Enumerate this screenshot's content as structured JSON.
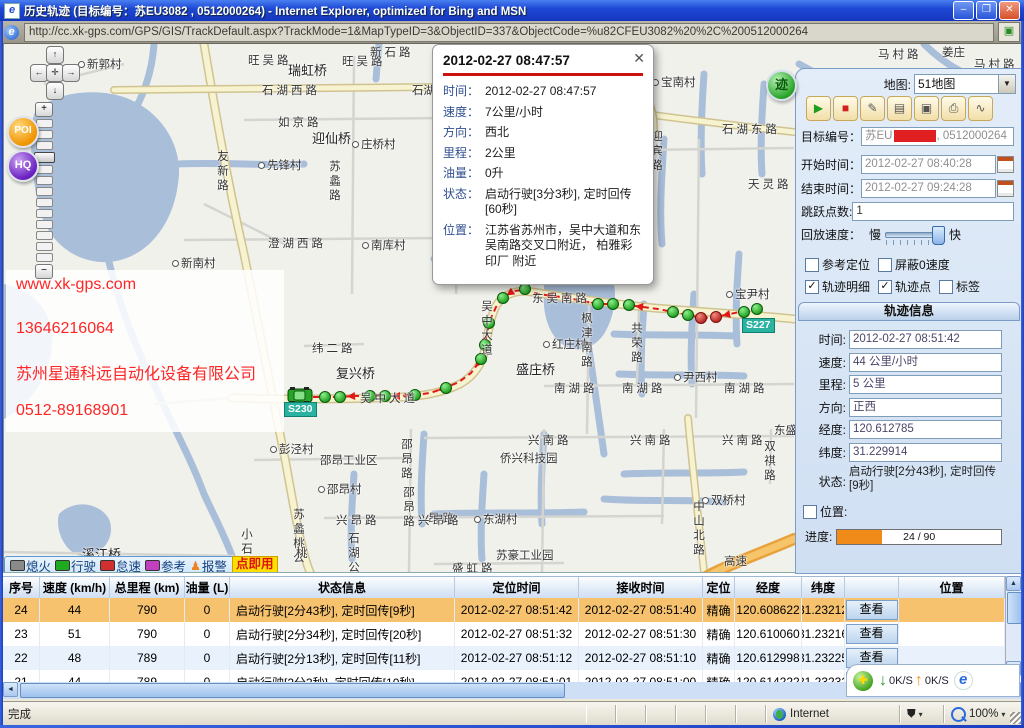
{
  "window": {
    "title": "历史轨迹 (目标编号：苏EU3082 , 0512000264) - Internet Explorer, optimized for Bing and MSN",
    "icon_glyph": "e",
    "controls": {
      "minimize": "–",
      "maximize": "❐",
      "close": "✕"
    }
  },
  "address_bar": {
    "url": "http://cc.xk-gps.com/GPS/GIS/TrackDefault.aspx?TrackMode=1&MapTypeID=3&ObjectID=337&ObjectCode=%u82CFEU3082%20%2C%200512000264",
    "page_icon": "▣"
  },
  "map": {
    "popup": {
      "title": "2012-02-27 08:47:57",
      "close": "✕",
      "fields": [
        {
          "label": "时间：",
          "value": "2012-02-27 08:47:57"
        },
        {
          "label": "速度：",
          "value": "7公里/小时"
        },
        {
          "label": "方向：",
          "value": "西北"
        },
        {
          "label": "里程：",
          "value": "2公里"
        },
        {
          "label": "油量：",
          "value": "0升"
        },
        {
          "label": "状态：",
          "value": "启动行驶[3分3秒], 定时回传[60秒]"
        },
        {
          "label": "位置：",
          "value": "江苏省苏州市，吴中大道和东吴南路交叉口附近， 柏雅彩印厂 附近"
        }
      ]
    },
    "watermark": [
      "www.xk-gps.com",
      "13646216064",
      "苏州星通科远自动化设备有限公司",
      "0512-89168901"
    ],
    "watermark_color": "#ff2626",
    "badges": [
      {
        "text": "S227",
        "x": 738,
        "y": 274
      },
      {
        "text": "S230",
        "x": 280,
        "y": 358
      }
    ],
    "poi_label": "POI",
    "hq_label": "HQ",
    "expand_label": "迹",
    "legend": {
      "items": [
        {
          "label": "熄火",
          "color": "#8a8a8a"
        },
        {
          "label": "行驶",
          "color": "#1faa1f"
        },
        {
          "label": "怠速",
          "color": "#d03030"
        },
        {
          "label": "参考",
          "color": "#c040c0"
        },
        {
          "label": "报警",
          "color": "#f08020",
          "person": true
        }
      ],
      "hint": "点即用"
    },
    "labels": [
      {
        "t": "新郭村",
        "x": 74,
        "y": 12,
        "dot": true
      },
      {
        "t": "旺吴路",
        "x": 244,
        "y": 8
      },
      {
        "t": "瑞虹桥",
        "x": 284,
        "y": 16,
        "b": true
      },
      {
        "t": "旺吴路",
        "x": 338,
        "y": 9
      },
      {
        "t": "新石路",
        "x": 366,
        "y": 0
      },
      {
        "t": "新石路",
        "x": 534,
        "y": 0
      },
      {
        "t": "石湖西路",
        "x": 258,
        "y": 38
      },
      {
        "t": "石湖",
        "x": 408,
        "y": 38
      },
      {
        "t": "如京路",
        "x": 274,
        "y": 70
      },
      {
        "t": "迎仙桥",
        "x": 308,
        "y": 84,
        "b": true
      },
      {
        "t": "庄桥村",
        "x": 348,
        "y": 92,
        "dot": true
      },
      {
        "t": "先锋村",
        "x": 254,
        "y": 113,
        "dot": true
      },
      {
        "t": "友新路",
        "x": 210,
        "y": 106,
        "v": true
      },
      {
        "t": "苏蠡路",
        "x": 322,
        "y": 116,
        "v": true
      },
      {
        "t": "澄湖西路",
        "x": 264,
        "y": 191
      },
      {
        "t": "南库村",
        "x": 358,
        "y": 193,
        "dot": true
      },
      {
        "t": "新南村",
        "x": 168,
        "y": 211,
        "dot": true
      },
      {
        "t": "宝南村",
        "x": 648,
        "y": 30,
        "dot": true
      },
      {
        "t": "石湖东路",
        "x": 718,
        "y": 77
      },
      {
        "t": "迎宾路",
        "x": 644,
        "y": 86,
        "v": true
      },
      {
        "t": "天灵路",
        "x": 744,
        "y": 132
      },
      {
        "t": "工业区",
        "x": 608,
        "y": 163
      },
      {
        "t": "吴中大道",
        "x": 474,
        "y": 256,
        "v": true
      },
      {
        "t": "东吴南路",
        "x": 528,
        "y": 246
      },
      {
        "t": "纬二路",
        "x": 308,
        "y": 296
      },
      {
        "t": "复兴桥",
        "x": 332,
        "y": 319,
        "b": true
      },
      {
        "t": "红庄村",
        "x": 539,
        "y": 292,
        "dot": true
      },
      {
        "t": "枫津南路",
        "x": 574,
        "y": 268,
        "v": true
      },
      {
        "t": "共荣路",
        "x": 624,
        "y": 278,
        "v": true
      },
      {
        "t": "盛庄桥",
        "x": 512,
        "y": 315,
        "b": true
      },
      {
        "t": "尹西村",
        "x": 670,
        "y": 325,
        "dot": true
      },
      {
        "t": "宝尹村",
        "x": 722,
        "y": 242,
        "dot": true
      },
      {
        "t": "南湖路",
        "x": 550,
        "y": 336
      },
      {
        "t": "南湖路",
        "x": 618,
        "y": 336
      },
      {
        "t": "南湖路",
        "x": 720,
        "y": 336
      },
      {
        "t": "吴中大道",
        "x": 356,
        "y": 346
      },
      {
        "t": "兴南路",
        "x": 524,
        "y": 388
      },
      {
        "t": "兴南路",
        "x": 626,
        "y": 388
      },
      {
        "t": "兴南路",
        "x": 718,
        "y": 388
      },
      {
        "t": "东盛",
        "x": 770,
        "y": 378
      },
      {
        "t": "双祺路",
        "x": 757,
        "y": 396,
        "v": true
      },
      {
        "t": "侨兴科技园",
        "x": 496,
        "y": 406
      },
      {
        "t": "双桥村",
        "x": 698,
        "y": 448,
        "dot": true
      },
      {
        "t": "中山北路",
        "x": 686,
        "y": 456,
        "v": true
      },
      {
        "t": "昂路",
        "x": 424,
        "y": 466
      },
      {
        "t": "东湖村",
        "x": 470,
        "y": 467,
        "dot": true
      },
      {
        "t": "彭泾村",
        "x": 266,
        "y": 397,
        "dot": true
      },
      {
        "t": "邵昂工业区",
        "x": 316,
        "y": 408
      },
      {
        "t": "邵昂村",
        "x": 314,
        "y": 437,
        "dot": true
      },
      {
        "t": "邵昂路",
        "x": 394,
        "y": 394,
        "v": true
      },
      {
        "t": "邵昂路",
        "x": 396,
        "y": 442,
        "v": true
      },
      {
        "t": "兴昂路",
        "x": 332,
        "y": 468
      },
      {
        "t": "兴昂路",
        "x": 414,
        "y": 468
      },
      {
        "t": "苏豪工业园",
        "x": 492,
        "y": 503
      },
      {
        "t": "盛虹路",
        "x": 448,
        "y": 516
      },
      {
        "t": "小石湖",
        "x": 234,
        "y": 484,
        "v": true
      },
      {
        "t": "苏蠡桃公",
        "x": 286,
        "y": 464,
        "v": true
      },
      {
        "t": "溪江桥",
        "x": 78,
        "y": 500,
        "b": true
      },
      {
        "t": "石湖公",
        "x": 341,
        "y": 488,
        "v": true
      },
      {
        "t": "桃",
        "x": 292,
        "y": 501
      },
      {
        "t": "高速",
        "x": 720,
        "y": 509
      },
      {
        "t": "马村路",
        "x": 874,
        "y": 2
      },
      {
        "t": "姜庄",
        "x": 938,
        "y": 0
      },
      {
        "t": "马村路",
        "x": 970,
        "y": 12
      }
    ],
    "track": {
      "path": [
        [
          753,
          265
        ],
        [
          740,
          267
        ],
        [
          726,
          270
        ],
        [
          712,
          273
        ],
        [
          698,
          274
        ],
        [
          684,
          271
        ],
        [
          669,
          268
        ],
        [
          654,
          265
        ],
        [
          639,
          263
        ],
        [
          624,
          261
        ],
        [
          609,
          260
        ],
        [
          594,
          260
        ],
        [
          579,
          257
        ],
        [
          564,
          254
        ],
        [
          549,
          252
        ],
        [
          534,
          250
        ],
        [
          521,
          246
        ],
        [
          509,
          247
        ],
        [
          500,
          253
        ],
        [
          492,
          263
        ],
        [
          486,
          276
        ],
        [
          483,
          290
        ],
        [
          480,
          304
        ],
        [
          476,
          317
        ],
        [
          467,
          329
        ],
        [
          455,
          338
        ],
        [
          441,
          344
        ],
        [
          426,
          349
        ],
        [
          411,
          351
        ],
        [
          396,
          352
        ],
        [
          381,
          352
        ],
        [
          366,
          352
        ],
        [
          351,
          352
        ],
        [
          336,
          353
        ],
        [
          321,
          353
        ],
        [
          307,
          353
        ]
      ],
      "points": [
        {
          "x": 753,
          "y": 265,
          "c": "g"
        },
        {
          "x": 740,
          "y": 268,
          "c": "g"
        },
        {
          "x": 712,
          "y": 273,
          "c": "r"
        },
        {
          "x": 697,
          "y": 274,
          "c": "r"
        },
        {
          "x": 684,
          "y": 271,
          "c": "g"
        },
        {
          "x": 669,
          "y": 268,
          "c": "g"
        },
        {
          "x": 625,
          "y": 261,
          "c": "g"
        },
        {
          "x": 609,
          "y": 260,
          "c": "g"
        },
        {
          "x": 594,
          "y": 260,
          "c": "g"
        },
        {
          "x": 521,
          "y": 245,
          "c": "g"
        },
        {
          "x": 499,
          "y": 254,
          "c": "g"
        },
        {
          "x": 485,
          "y": 279,
          "c": "g"
        },
        {
          "x": 481,
          "y": 301,
          "c": "g"
        },
        {
          "x": 477,
          "y": 315,
          "c": "g"
        },
        {
          "x": 442,
          "y": 344,
          "c": "g"
        },
        {
          "x": 411,
          "y": 351,
          "c": "g"
        },
        {
          "x": 381,
          "y": 352,
          "c": "g"
        },
        {
          "x": 366,
          "y": 352,
          "c": "g"
        },
        {
          "x": 336,
          "y": 353,
          "c": "g"
        },
        {
          "x": 321,
          "y": 353,
          "c": "g"
        }
      ],
      "car": {
        "x": 296,
        "y": 352
      }
    }
  },
  "sidebar": {
    "map_select_label": "地图:",
    "map_select_value": "51地图",
    "dd_arrow": "▼",
    "toolbar": [
      {
        "name": "play",
        "glyph": "▶",
        "color": "#1e9e1e"
      },
      {
        "name": "stop",
        "glyph": "■",
        "color": "#d02020"
      },
      {
        "name": "erase",
        "glyph": "✎",
        "color": "#555555"
      },
      {
        "name": "ruler",
        "glyph": "▤",
        "color": "#555555"
      },
      {
        "name": "measure-area",
        "glyph": "▣",
        "color": "#555555"
      },
      {
        "name": "print",
        "glyph": "⎙",
        "color": "#555555"
      },
      {
        "name": "speed-curve",
        "glyph": "∿",
        "color": "#555555"
      }
    ],
    "target_label": "目标编号：",
    "target_prefix": "苏EU",
    "target_suffix": ", 0512000264",
    "start_label": "开始时间：",
    "start_value": "2012-02-27 08:40:28",
    "end_label": "结束时间：",
    "end_value": "2012-02-27 09:24:28",
    "skip_label": "跳跃点数:",
    "skip_value": "1",
    "speed_label": "回放速度：",
    "slow": "慢",
    "fast": "快",
    "checks": [
      {
        "label": "参考定位",
        "checked": false
      },
      {
        "label": "屏蔽0速度",
        "checked": false
      },
      {
        "label": "轨迹明细",
        "checked": true
      },
      {
        "label": "轨迹点",
        "checked": true
      },
      {
        "label": "标签",
        "checked": false
      }
    ]
  },
  "track_info": {
    "header": "轨迹信息",
    "rows": [
      {
        "label": "时间:",
        "value": "2012-02-27 08:51:42"
      },
      {
        "label": "速度:",
        "value": "44 公里/小时"
      },
      {
        "label": "里程:",
        "value": "5 公里"
      },
      {
        "label": "方向:",
        "value": "正西"
      },
      {
        "label": "经度:",
        "value": "120.612785"
      },
      {
        "label": "纬度:",
        "value": "31.229914"
      }
    ],
    "status_label": "状态:",
    "status_value": "启动行驶[2分43秒], 定时回传[9秒]",
    "location_label": "位置:",
    "progress_label": "进度:",
    "progress_text": "24 / 90",
    "progress_pct": 27
  },
  "table": {
    "headers": [
      "序号",
      "速度 (km/h)",
      "总里程 (km)",
      "油量 (L)",
      "状态信息",
      "定位时间",
      "接收时间",
      "定位",
      "经度",
      "纬度",
      "",
      "位置"
    ],
    "view_label": "查看",
    "rows": [
      {
        "seq": "24",
        "speed": "44",
        "total": "790",
        "fuel": "0",
        "status": "启动行驶[2分43秒], 定时回传[9秒]",
        "fix_time": "2012-02-27 08:51:42",
        "recv_time": "2012-02-27 08:51:40",
        "fix": "精确",
        "lng": "120.608622",
        "lat": "31.23212",
        "position": "",
        "selected": true
      },
      {
        "seq": "23",
        "speed": "51",
        "total": "790",
        "fuel": "0",
        "status": "启动行驶[2分34秒], 定时回传[20秒]",
        "fix_time": "2012-02-27 08:51:32",
        "recv_time": "2012-02-27 08:51:30",
        "fix": "精确",
        "lng": "120.610060",
        "lat": "31.23216",
        "position": ""
      },
      {
        "seq": "22",
        "speed": "48",
        "total": "789",
        "fuel": "0",
        "status": "启动行驶[2分13秒], 定时回传[11秒]",
        "fix_time": "2012-02-27 08:51:12",
        "recv_time": "2012-02-27 08:51:10",
        "fix": "精确",
        "lng": "120.612998",
        "lat": "31.23225",
        "position": "",
        "alt": true
      },
      {
        "seq": "21",
        "speed": "44",
        "total": "789",
        "fuel": "0",
        "status": "启动行驶[2分3秒], 定时回传[10秒]",
        "fix_time": "2012-02-27 08:51:01",
        "recv_time": "2012-02-27 08:51:00",
        "fix": "精确",
        "lng": "120.614222",
        "lat": "31.23232",
        "position": "",
        "partial": true
      }
    ]
  },
  "net_panel": {
    "down_speed": "0K/S",
    "up_speed": "0K/S",
    "down_arrow": "↓",
    "up_arrow": "↑",
    "ie_glyph": "e",
    "orb_glyph": "✚"
  },
  "status_bar": {
    "text": "完成",
    "zone": "Internet",
    "zoom": "100%",
    "caret": "▾"
  }
}
